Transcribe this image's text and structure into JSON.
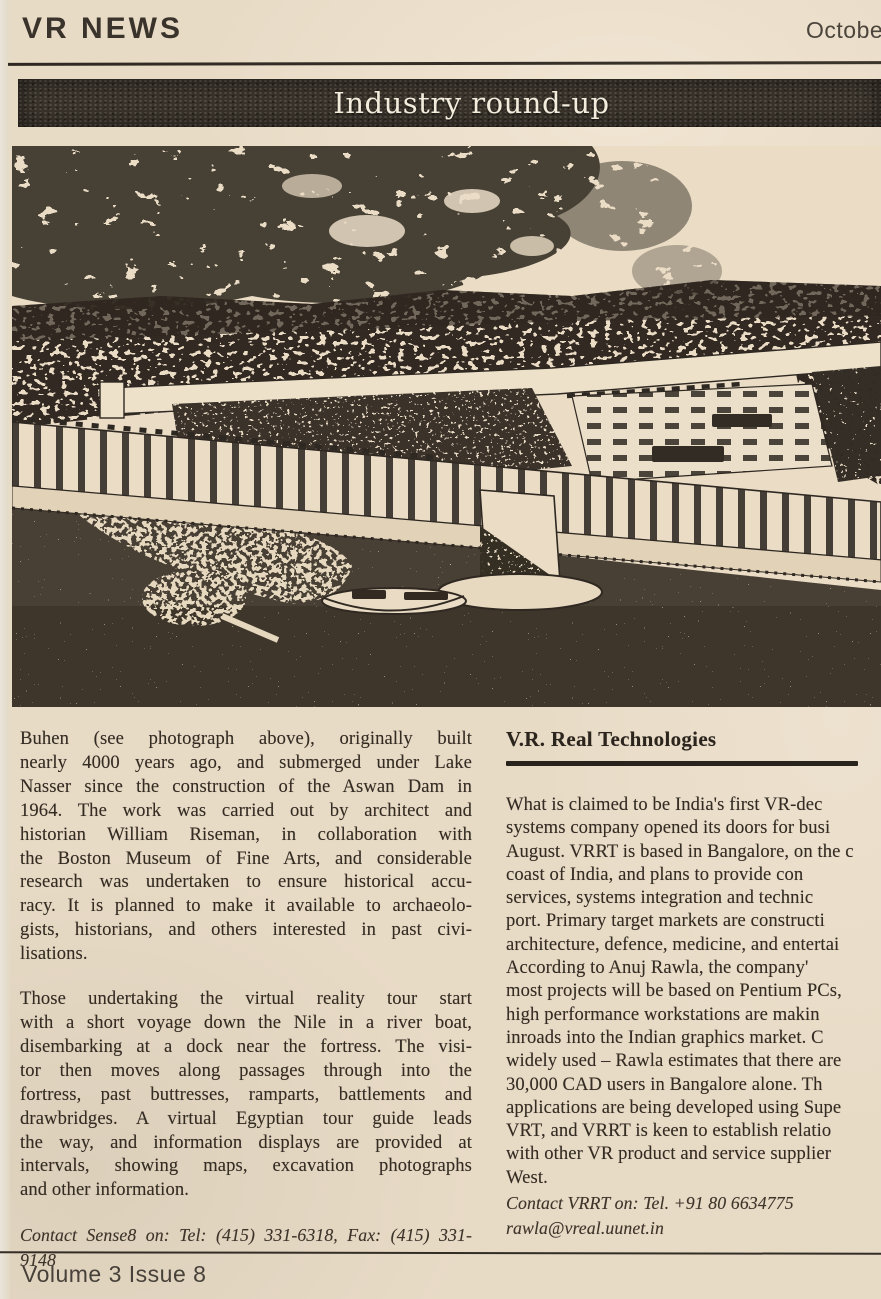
{
  "page": {
    "masthead": "VR NEWS",
    "issue_date": "October",
    "section_banner": "Industry round-up",
    "footer": "Volume 3 Issue 8"
  },
  "colors": {
    "paper": "#e8dbc6",
    "ink": "#342c23",
    "banner_bg": "#38322a",
    "banner_text": "#f3ecdc"
  },
  "photo": {
    "description": "halftone aerial reconstruction of the fortress of Buhen beside the Nile"
  },
  "left_column": {
    "para1_lines": [
      "Buhen (see photograph above), originally built",
      "nearly 4000 years ago, and submerged under Lake",
      "Nasser since the construction of the Aswan Dam in",
      "1964. The work was carried out by architect and",
      "historian William Riseman, in collaboration with",
      "the Boston Museum of Fine Arts, and considerable",
      "research was undertaken to ensure historical accu-",
      "racy. It is planned to make it available to archaeolo-",
      "gists, historians, and others interested in past civi-",
      "lisations."
    ],
    "para2_lines": [
      "Those undertaking the virtual reality tour start",
      "with a short voyage down the Nile in a river boat,",
      "disembarking at a dock near the fortress. The visi-",
      "tor then moves along passages through into the",
      "fortress, past buttresses, ramparts, battlements and",
      "drawbridges. A virtual Egyptian tour guide leads",
      "the way, and information displays are provided at",
      "intervals, showing maps, excavation photographs",
      "and other information."
    ],
    "contact_lines": [
      "Contact Sense8 on: Tel: (415) 331-6318, Fax: (415) 331-",
      "9148"
    ]
  },
  "right_column": {
    "heading": "V.R. Real Technologies",
    "body_lines": [
      "What is claimed to be India's first VR-dec",
      "systems company opened its doors for busi",
      "August. VRRT is based in Bangalore, on the c",
      "coast of India, and plans to provide con",
      "services, systems integration and technic",
      "port. Primary target markets are constructi",
      "architecture, defence, medicine, and entertai",
      "According to Anuj Rawla, the company'",
      "most projects will be based on Pentium PCs,",
      "high performance workstations are makin",
      "inroads into the Indian graphics market. C",
      "widely used – Rawla estimates that there are",
      "30,000 CAD users in Bangalore alone. Th",
      "applications are being developed using Supe",
      "VRT, and VRRT is keen to establish relatio",
      "with other VR product and service supplier",
      "West."
    ],
    "contact_lines": [
      "Contact VRRT on: Tel. +91 80 6634775",
      "rawla@vreal.uunet.in"
    ]
  }
}
